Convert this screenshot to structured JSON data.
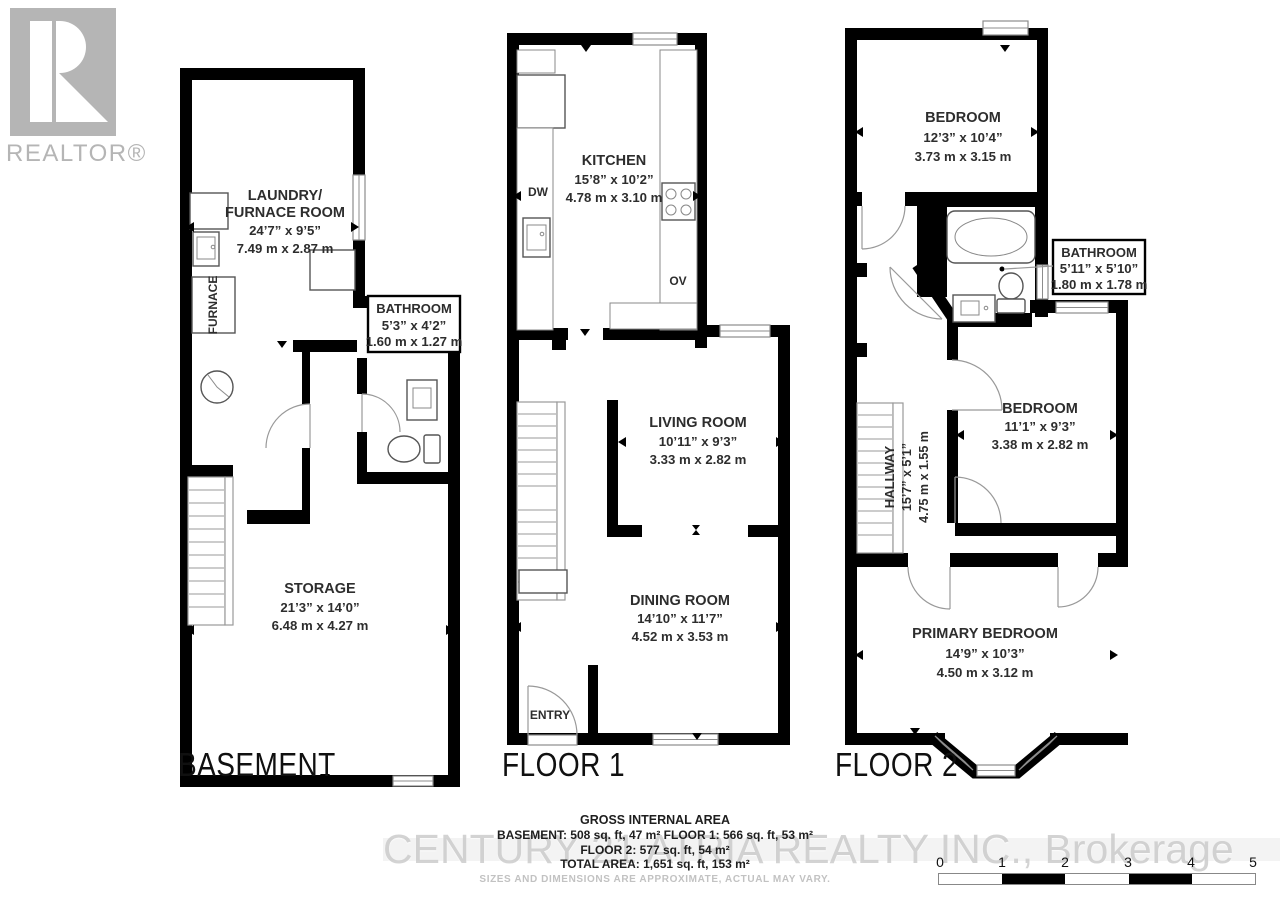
{
  "logo": {
    "text": "REALTOR®"
  },
  "basement": {
    "title": "BASEMENT",
    "laundry_name1": "LAUNDRY/",
    "laundry_name2": "FURNACE ROOM",
    "laundry_imp": "24’7” x 9’5”",
    "laundry_met": "7.49 m x 2.87 m",
    "furnace": "FURNACE",
    "bath_name": "BATHROOM",
    "bath_imp": "5’3” x 4’2”",
    "bath_met": "1.60 m x 1.27 m",
    "storage_name": "STORAGE",
    "storage_imp": "21’3” x 14’0”",
    "storage_met": "6.48 m x 4.27 m"
  },
  "floor1": {
    "title": "FLOOR 1",
    "kitchen_name": "KITCHEN",
    "kitchen_imp": "15’8” x 10’2”",
    "kitchen_met": "4.78 m x 3.10 m",
    "dw": "DW",
    "ov": "OV",
    "living_name": "LIVING ROOM",
    "living_imp": "10’11” x 9’3”",
    "living_met": "3.33 m x 2.82 m",
    "dining_name": "DINING ROOM",
    "dining_imp": "14’10” x 11’7”",
    "dining_met": "4.52 m x 3.53 m",
    "entry": "ENTRY"
  },
  "floor2": {
    "title": "FLOOR 2",
    "bed1_name": "BEDROOM",
    "bed1_imp": "12’3” x 10’4”",
    "bed1_met": "3.73 m x 3.15 m",
    "bath_name": "BATHROOM",
    "bath_imp": "5’11” x 5’10”",
    "bath_met": "1.80 m x 1.78 m",
    "hall_name": "HALLWAY",
    "hall_imp": "15’7” x 5’1”",
    "hall_met": "4.75 m x 1.55 m",
    "bed2_name": "BEDROOM",
    "bed2_imp": "11’1” x 9’3”",
    "bed2_met": "3.38 m x 2.82 m",
    "primary_name": "PRIMARY BEDROOM",
    "primary_imp": "14’9” x 10’3”",
    "primary_met": "4.50 m x 3.12 m"
  },
  "summary": {
    "title": "GROSS INTERNAL AREA",
    "line1": "BASEMENT: 508 sq. ft, 47 m²  FLOOR 1: 566 sq. ft, 53 m²",
    "line2": "FLOOR 2: 577 sq. ft, 54 m²",
    "line3": "TOTAL AREA: 1,651 sq. ft, 153 m²",
    "disclaimer": "SIZES AND DIMENSIONS ARE APPROXIMATE, ACTUAL MAY VARY."
  },
  "watermark": "CENTURY 21 ATRIA REALTY INC., Brokerage",
  "scale": {
    "t0": "0",
    "t1": "1",
    "t2": "2",
    "t3": "3",
    "t4": "4",
    "t5": "5"
  },
  "colors": {
    "wall": "#000000",
    "text": "#2d2d2d",
    "light_gray": "#b5b5b5"
  }
}
